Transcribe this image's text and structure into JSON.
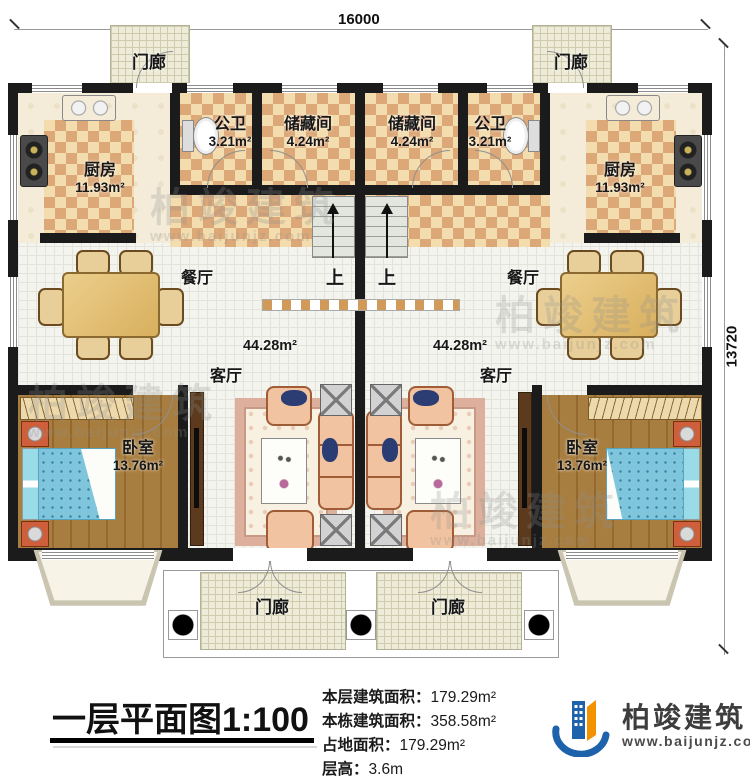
{
  "dims": {
    "top": "16000",
    "right": "13720"
  },
  "rooms": {
    "porch": "门廊",
    "kitchen": "厨房",
    "kitchen_area": "11.93m²",
    "bath": "公卫",
    "bath_area": "3.21m²",
    "storage": "储藏间",
    "storage_area": "4.24m²",
    "dining": "餐厅",
    "hall": "客厅",
    "hall_area": "44.28m²",
    "bedroom": "卧室",
    "bedroom_area": "13.76m²",
    "up": "上"
  },
  "titleblock": {
    "title": "一层平面图",
    "scale": "1:100",
    "stats": [
      {
        "label": "本层建筑面积：",
        "value": "179.29m²"
      },
      {
        "label": "本栋建筑面积：",
        "value": "358.58m²"
      },
      {
        "label": "占地面积：",
        "value": "179.29m²"
      },
      {
        "label": "层高：",
        "value": "3.6m"
      }
    ]
  },
  "logo": {
    "name": "柏竣建筑",
    "site": "www.baijunjz.com"
  },
  "watermark": {
    "name": "柏竣建筑",
    "site": "www.baijunjz.com"
  },
  "colors": {
    "wall": "#1b1b1b",
    "checker_light": "#f3dcae",
    "checker_dark": "#dca878",
    "wood_floor": "#a87e40",
    "bed_blue": "#7fc6dd",
    "sofa_peach": "#f2c3a0",
    "porch_floor": "#eeecd8",
    "logo_blue": "#1e62ac",
    "logo_orange": "#f29200"
  }
}
